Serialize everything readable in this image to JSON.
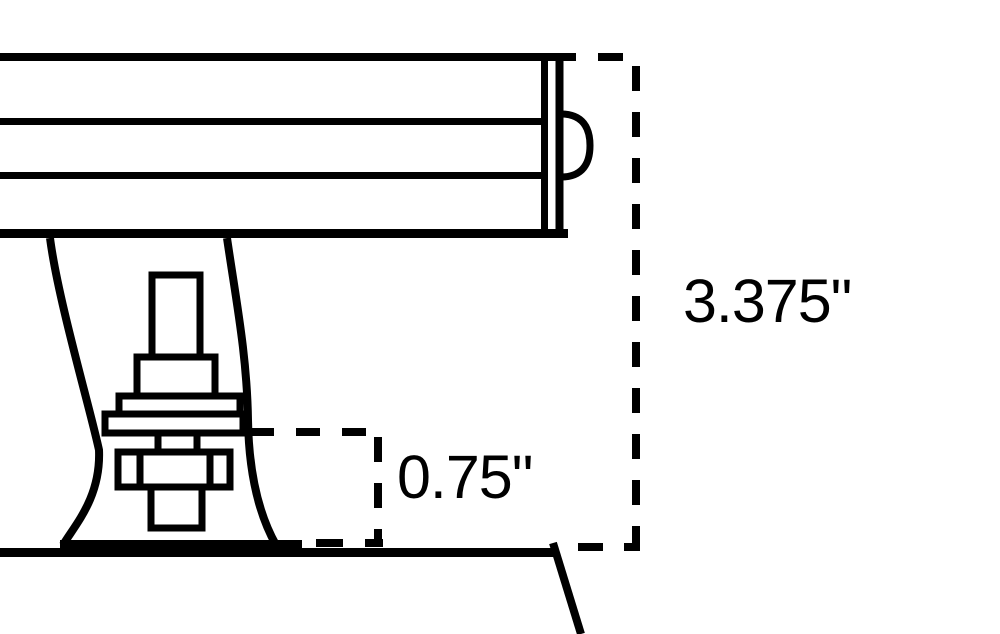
{
  "page": {
    "background_color": "#ffffff",
    "line_color": "#000000"
  },
  "drawing": {
    "kind": "technical-dimension-drawing",
    "labels": {
      "height_dimension": "3.375\"",
      "offset_dimension": "0.75\""
    },
    "dimensions": [
      {
        "name": "overall-height",
        "value": 3.375,
        "unit": "inches",
        "text": "3.375\""
      },
      {
        "name": "base-height",
        "value": 0.75,
        "unit": "inches",
        "text": "0.75\""
      }
    ]
  }
}
